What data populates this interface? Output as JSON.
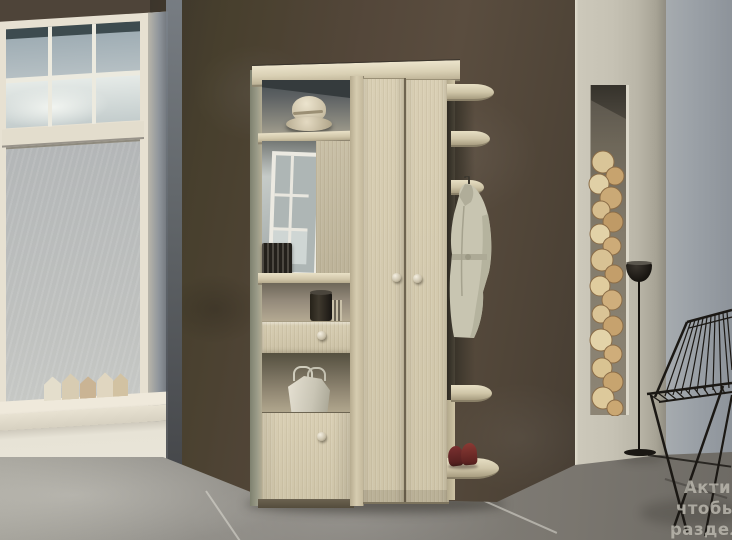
{
  "scene": {
    "type": "interior-photo",
    "subject": "Hallway entryway wardrobe unit (light oak) against a dark accent wall, with window, decorative firewood niche, floor lamp and wire chair",
    "objects": [
      "window",
      "decor-houses",
      "dark-accent-wall",
      "entry-unit",
      "hat-on-top-shelf",
      "mirror",
      "radio",
      "open-shelf-canister",
      "drawer",
      "niche-with-bag",
      "lower-cabinet-door",
      "wardrobe-doors",
      "corner-shelves",
      "hanging-coat",
      "red-shoes",
      "firewood-niche",
      "floor-lamp",
      "wire-chair"
    ]
  },
  "watermark": {
    "line1": "Актив",
    "line2": "чтобы",
    "line3": "раздел"
  },
  "palette": {
    "wood_light": "#d5cbb0",
    "wall_dark": "#4e4439",
    "wall_light": "#c4c0b2",
    "wall_blue": "#9aa0a6",
    "floor": "#8a8781",
    "window_frame": "#e7e1d2",
    "sky": "#aeb9bf",
    "coat": "#c8c5b1",
    "shoes": "#6a2b26",
    "metal_black": "#1a1713",
    "firewood": "#d9c598"
  }
}
